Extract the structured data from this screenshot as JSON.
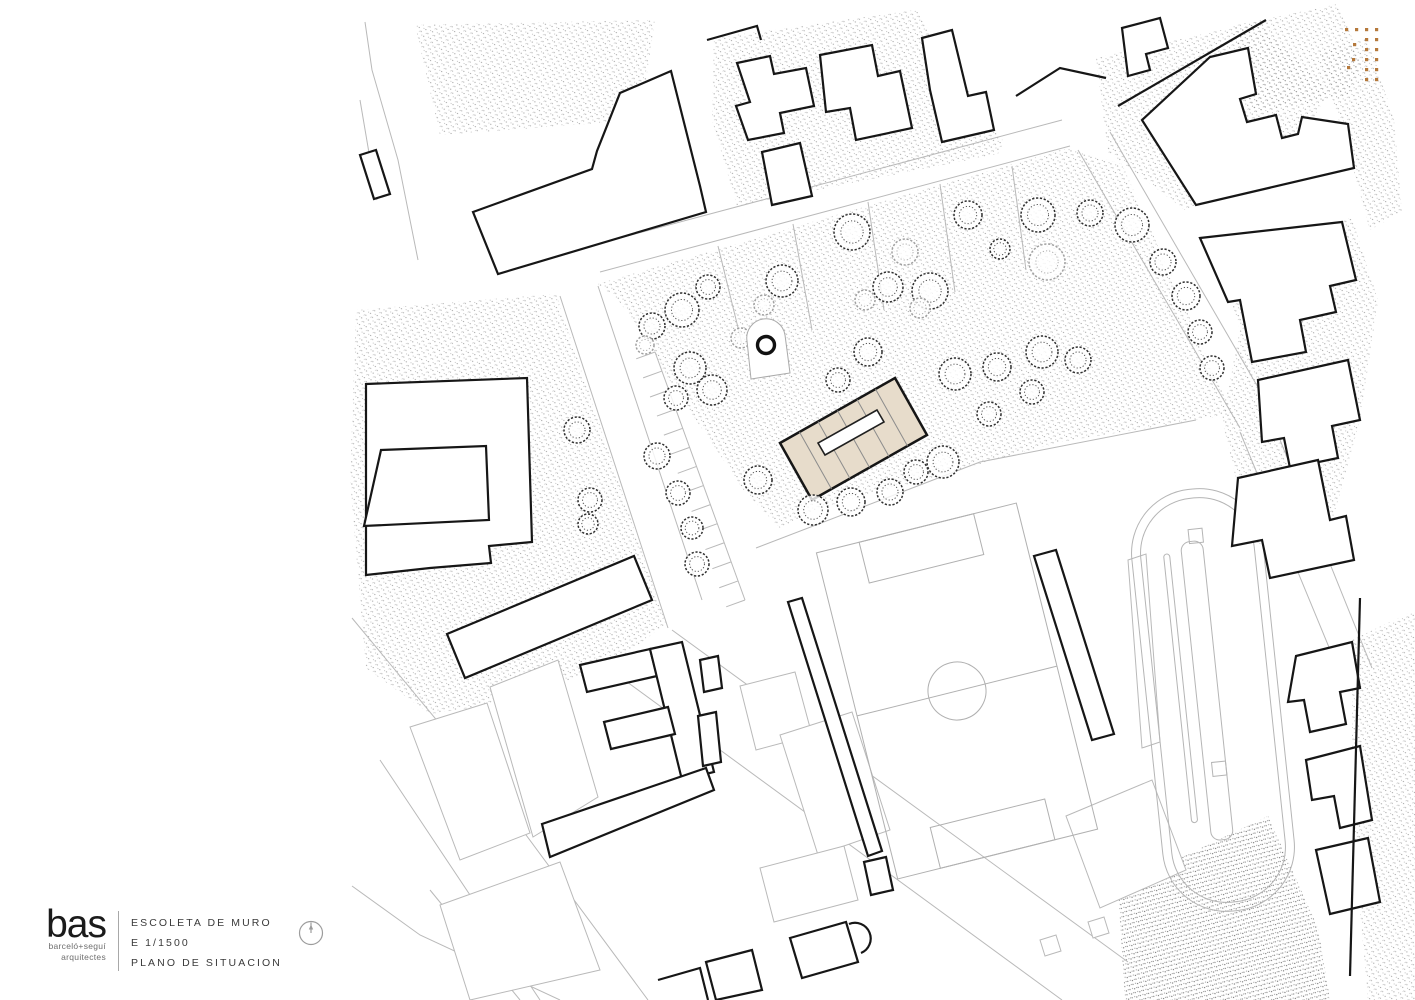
{
  "title_block": {
    "logo_text": "bas",
    "logo_sub1": "barceló+seguí",
    "logo_sub2": "arquitectes",
    "project_name": "ESCOLETA DE MURO",
    "scale_label": "E 1/1500",
    "drawing_label": "PLANO DE SITUACION"
  },
  "colors": {
    "background": "#ffffff",
    "heavy_line": "#161616",
    "light_line": "#b9b9b9",
    "mid_line": "#8c8c8c",
    "stipple": "#8e8e8e",
    "highlight_fill": "#e7dccb",
    "accent_dots": "#b5793c",
    "titleblock_text": "#3a3a3a"
  },
  "plan": {
    "stipple_areas": [
      {
        "pts": "415,25 655,20 640,120 440,135",
        "dense": false
      },
      {
        "pts": "598,284 1068,148 1122,164 1232,414 1060,442 905,485 820,508 780,528 745,492 718,452 696,420 664,372 640,330 618,300",
        "dense": false
      },
      {
        "pts": "356,310 556,294 666,624 612,664 520,700 430,714 366,668 350,480",
        "dense": false
      },
      {
        "pts": "714,38 916,10 1004,142 998,154 737,206 712,120",
        "dense": false
      },
      {
        "pts": "1096,58 1257,22 1330,90 1290,158 1185,210 1108,152",
        "dense": false
      },
      {
        "pts": "1232,26 1338,4 1362,62 1348,96 1252,112",
        "dense": false
      },
      {
        "pts": "1216,250 1352,218 1378,300 1360,420 1330,530 1252,545 1222,420 1240,330",
        "dense": false
      },
      {
        "pts": "1318,52 1368,38 1394,120 1402,212 1370,230 1348,150",
        "dense": false
      },
      {
        "pts": "1118,888 1268,816 1318,928 1330,1000 1125,1000",
        "dense": true
      },
      {
        "pts": "1352,640 1415,610 1415,1000 1368,1000 1352,820",
        "dense": false
      }
    ],
    "light_lines": [
      "365,22 372,70 398,160 418,260",
      "360,100 377,200",
      "352,618 478,770 648,1000",
      "380,760 540,1000",
      "560,296 668,628",
      "598,286 702,600",
      "600,272 1070,146",
      "590,246 1062,120",
      "1078,150 1240,428",
      "1110,132 1270,408",
      "608,668 1062,1000",
      "672,630 1128,962",
      "1240,432 1345,686",
      "1270,415 1372,668",
      "380,420 520,414",
      "448,384 452,448",
      "410,520 410,560",
      "718,246 742,344",
      "793,224 812,330",
      "868,202 884,310",
      "940,184 955,292",
      "1012,166 1026,270",
      "756,548 980,462 1196,420",
      "352,886 420,935 560,1000",
      "430,890 520,1000"
    ],
    "light_polys": [
      "410,727 487,703 530,833 460,860",
      "490,687 558,660 598,797 533,837",
      "440,905 560,862 600,970 470,1000",
      "740,686 795,672 812,735 756,750",
      "780,735 852,712 890,830 818,855",
      "1066,816 1152,780 1186,870 1100,908",
      "1088,922 1104,917 1109,933 1093,938",
      "1040,940 1056,935 1061,951 1045,956",
      "1128,560 1146,554 1160,742 1142,748",
      "760,868 844,846 858,900 774,922"
    ],
    "heavy_polys": [
      "360,155 376,150 390,194 374,199",
      "473,212 592,169 597,151 620,93 671,71 700,186 706,212 498,274",
      "737,63 770,56 774,74 806,68 814,106 780,113 784,133 748,140 736,106 750,102",
      "820,55 872,45 878,76 900,71 912,128 856,140 850,108 826,112",
      "922,38 952,30 968,96 986,92 994,130 942,142 930,90",
      "762,152 800,143 812,196 772,205",
      "1122,28 1160,18 1168,48 1146,54 1150,70 1128,76",
      "1142,120 1210,57 1248,48 1256,94 1240,99 1247,122 1276,115 1282,138 1298,134 1302,117 1348,124 1354,168 1196,205",
      "1200,238 1342,222 1356,280 1330,286 1336,312 1300,320 1306,352 1252,362 1240,300 1228,302",
      "1258,380 1348,360 1360,420 1332,426 1338,458 1290,468 1284,438 1262,442",
      "1238,478 1318,460 1330,520 1346,516 1354,560 1270,578 1262,540 1232,546",
      "1034,556 1056,550 1114,734 1092,740",
      "788,602 802,598 882,851 868,856",
      "366,384 527,378 532,542 489,546 491,563 430,568 366,575",
      "381,450 486,446 489,520 364,526",
      "447,634 634,556 652,600 465,678",
      "580,665 650,649 657,676 587,692",
      "650,649 682,642 714,772 682,780",
      "604,722 668,707 675,734 611,749",
      "542,824 706,768 714,790 550,857",
      "700,660 718,656 722,688 704,692",
      "698,716 716,712 721,762 703,766",
      "864,862 886,857 893,890 871,895",
      "790,938 846,922 858,962 802,978",
      "706,962 752,950 762,990 716,1000",
      "1296,656 1352,642 1360,688 1340,692 1346,724 1310,732 1304,700 1288,702",
      "1306,760 1360,746 1372,820 1340,828 1334,796 1312,800",
      "1316,850 1368,838 1380,902 1330,914"
    ],
    "heavy_lines": [
      "707,40 757,26 761,40",
      "1016,96 1060,68 1106,78",
      "1118,106 1266,20",
      "1360,598 1350,976",
      "658,980 700,968 708,1000"
    ],
    "heavy_paths": [
      "M849,924 A15,15 0 0 1 861,953"
    ],
    "parking": {
      "x1": 655,
      "y1": 352,
      "x2": 745,
      "y2": 600,
      "n": 13,
      "len": 20
    },
    "field": {
      "cx": 957,
      "cy": 691,
      "angle": -14,
      "w": 206,
      "h": 336,
      "r": 29,
      "pw": 118,
      "pd": 42
    },
    "track": {
      "cx": 1213,
      "cy": 700,
      "angle": -6,
      "len": 424,
      "wid": 132
    },
    "trees": [
      [
        652,
        326,
        13,
        0
      ],
      [
        682,
        310,
        17,
        0
      ],
      [
        708,
        287,
        12,
        0
      ],
      [
        690,
        368,
        16,
        0
      ],
      [
        712,
        390,
        15,
        0
      ],
      [
        676,
        398,
        12,
        0
      ],
      [
        782,
        281,
        16,
        0
      ],
      [
        852,
        232,
        18,
        0
      ],
      [
        888,
        287,
        15,
        0
      ],
      [
        930,
        291,
        18,
        0
      ],
      [
        968,
        215,
        14,
        0
      ],
      [
        1038,
        215,
        17,
        0
      ],
      [
        1090,
        213,
        13,
        0
      ],
      [
        1132,
        225,
        17,
        0
      ],
      [
        1163,
        262,
        13,
        0
      ],
      [
        1186,
        296,
        14,
        0
      ],
      [
        1200,
        332,
        12,
        0
      ],
      [
        1212,
        368,
        12,
        0
      ],
      [
        838,
        380,
        12,
        0
      ],
      [
        868,
        352,
        14,
        0
      ],
      [
        1000,
        249,
        10,
        0
      ],
      [
        955,
        374,
        16,
        0
      ],
      [
        997,
        367,
        14,
        0
      ],
      [
        1042,
        352,
        16,
        0
      ],
      [
        1078,
        360,
        13,
        0
      ],
      [
        1032,
        392,
        12,
        0
      ],
      [
        989,
        414,
        12,
        0
      ],
      [
        943,
        462,
        16,
        0
      ],
      [
        916,
        472,
        12,
        0
      ],
      [
        758,
        480,
        14,
        0
      ],
      [
        813,
        510,
        15,
        0
      ],
      [
        851,
        502,
        14,
        0
      ],
      [
        890,
        492,
        13,
        0
      ],
      [
        577,
        430,
        13,
        0
      ],
      [
        590,
        500,
        12,
        0
      ],
      [
        588,
        524,
        10,
        0
      ],
      [
        657,
        456,
        13,
        0
      ],
      [
        678,
        493,
        12,
        0
      ],
      [
        692,
        528,
        11,
        0
      ],
      [
        697,
        564,
        12,
        0
      ],
      [
        1047,
        262,
        18,
        1
      ],
      [
        905,
        252,
        13,
        1
      ],
      [
        920,
        308,
        10,
        1
      ],
      [
        865,
        300,
        10,
        1
      ],
      [
        741,
        338,
        10,
        1
      ],
      [
        764,
        305,
        10,
        1
      ],
      [
        645,
        345,
        9,
        1
      ]
    ],
    "escoleta": {
      "outer": "895,378 927,435 812,500 780,443",
      "court": "877,410 884,422 825,455 818,443",
      "dividers": [
        "875.5,389 907.5,446",
        "857,399.5 889,456.5",
        "837.5,410.5 869.5,467.5",
        "818,421.5 850,478.5",
        "799.5,432 831.5,489"
      ]
    },
    "landmark": {
      "path": "M751,379 L747,341 A19,19 0 0 1 785,335 L790,373 Z",
      "cx": 766,
      "cy": 345,
      "r": 8.5
    },
    "accent_dots": [
      [
        1345,
        28
      ],
      [
        1355,
        28
      ],
      [
        1365,
        28
      ],
      [
        1375,
        28
      ],
      [
        1365,
        38
      ],
      [
        1375,
        38
      ],
      [
        1353,
        43
      ],
      [
        1365,
        48
      ],
      [
        1375,
        48
      ],
      [
        1352,
        58
      ],
      [
        1365,
        58
      ],
      [
        1375,
        58
      ],
      [
        1347,
        66
      ],
      [
        1365,
        68
      ],
      [
        1375,
        68
      ],
      [
        1365,
        78
      ],
      [
        1375,
        78
      ]
    ]
  }
}
